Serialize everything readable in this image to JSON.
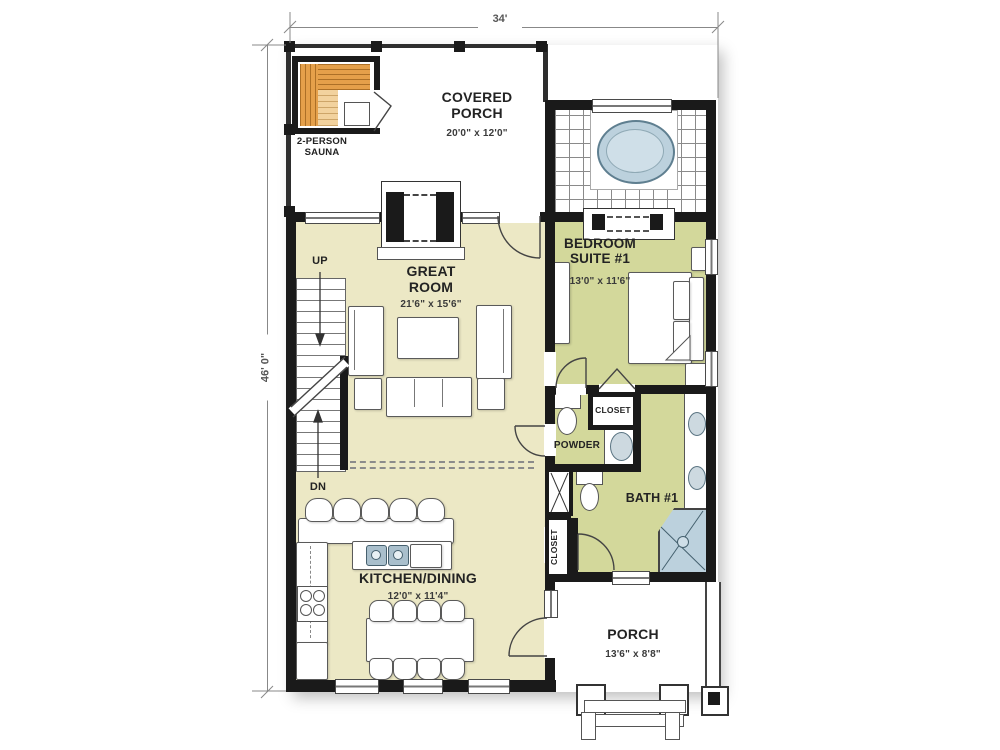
{
  "dimensions": {
    "width": "34'",
    "height": "46' 0\""
  },
  "rooms": {
    "covered_porch": {
      "name": "COVERED PORCH",
      "size": "20'0\" x 12'0\""
    },
    "sauna": {
      "name": "2-PERSON SAUNA"
    },
    "great_room": {
      "name": "GREAT ROOM",
      "size": "21'6\" x 15'6\""
    },
    "bedroom_suite_1": {
      "name": "BEDROOM SUITE #1",
      "size": "13'0\" x 11'6\""
    },
    "kitchen_dining": {
      "name": "KITCHEN/DINING",
      "size": "12'0\" x 11'4\""
    },
    "bath_1": {
      "name": "BATH #1"
    },
    "powder": {
      "name": "POWDER"
    },
    "bedroom_closet": {
      "name": "CLOSET"
    },
    "hall_closet": {
      "name": "CLOSET"
    },
    "porch": {
      "name": "PORCH",
      "size": "13'6\" x 8'8\""
    }
  },
  "stairs": {
    "up": "UP",
    "down": "DN"
  },
  "colors": {
    "wall": "#1a1a1a",
    "floor_main": "#ece8c5",
    "floor_suite": "#d3d89b",
    "wood": "#e5a04a",
    "wood_light": "#f2d29e",
    "water": "#bcd1dd"
  }
}
